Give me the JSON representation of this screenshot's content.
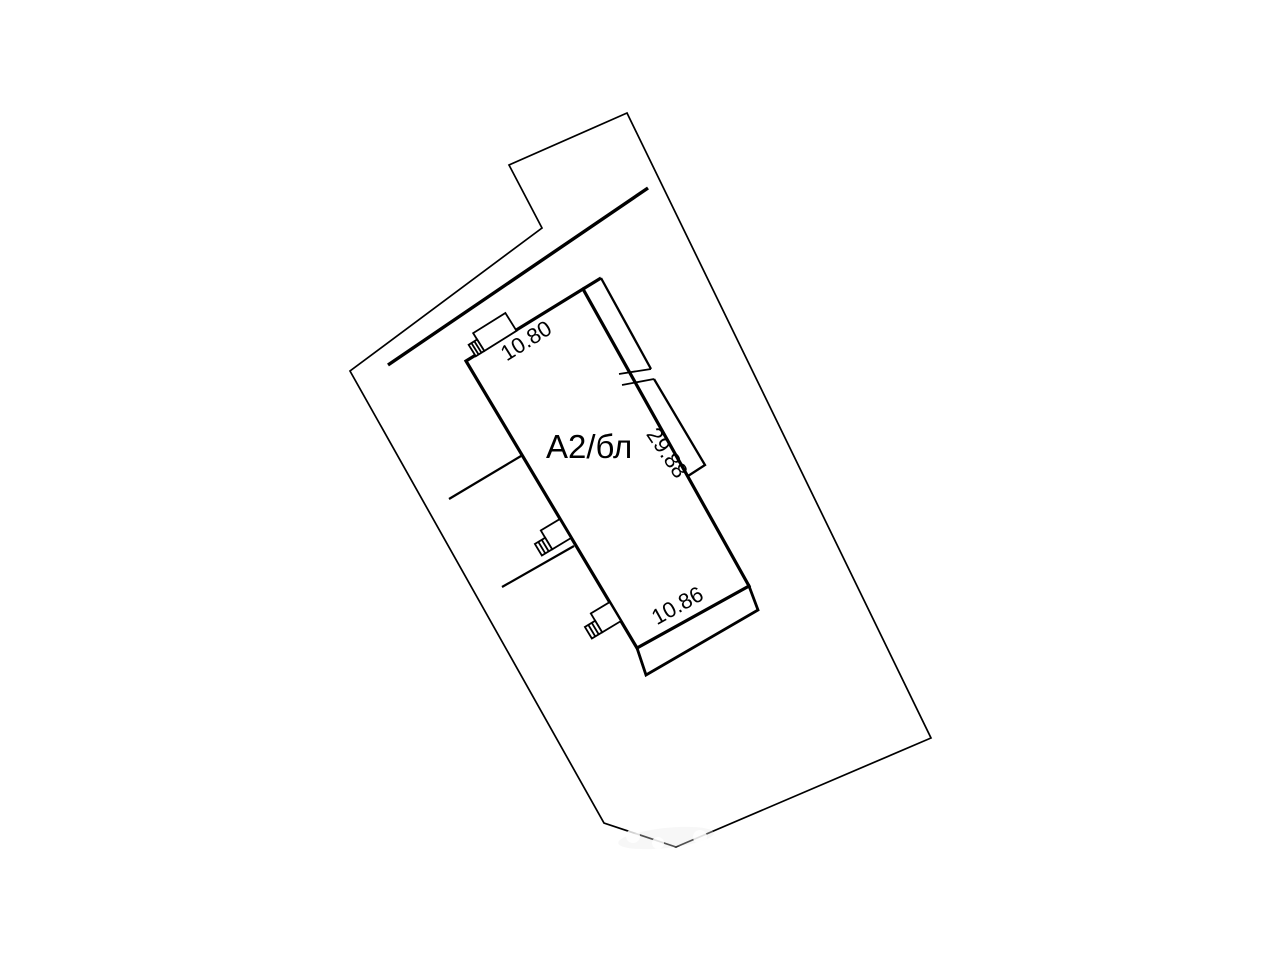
{
  "colors": {
    "background": "#ffffff",
    "ink": "#000000"
  },
  "plan": {
    "building_label": "А2/бл",
    "dim_top": "10.80",
    "dim_right": "29.88",
    "dim_bottom": "10.86"
  }
}
